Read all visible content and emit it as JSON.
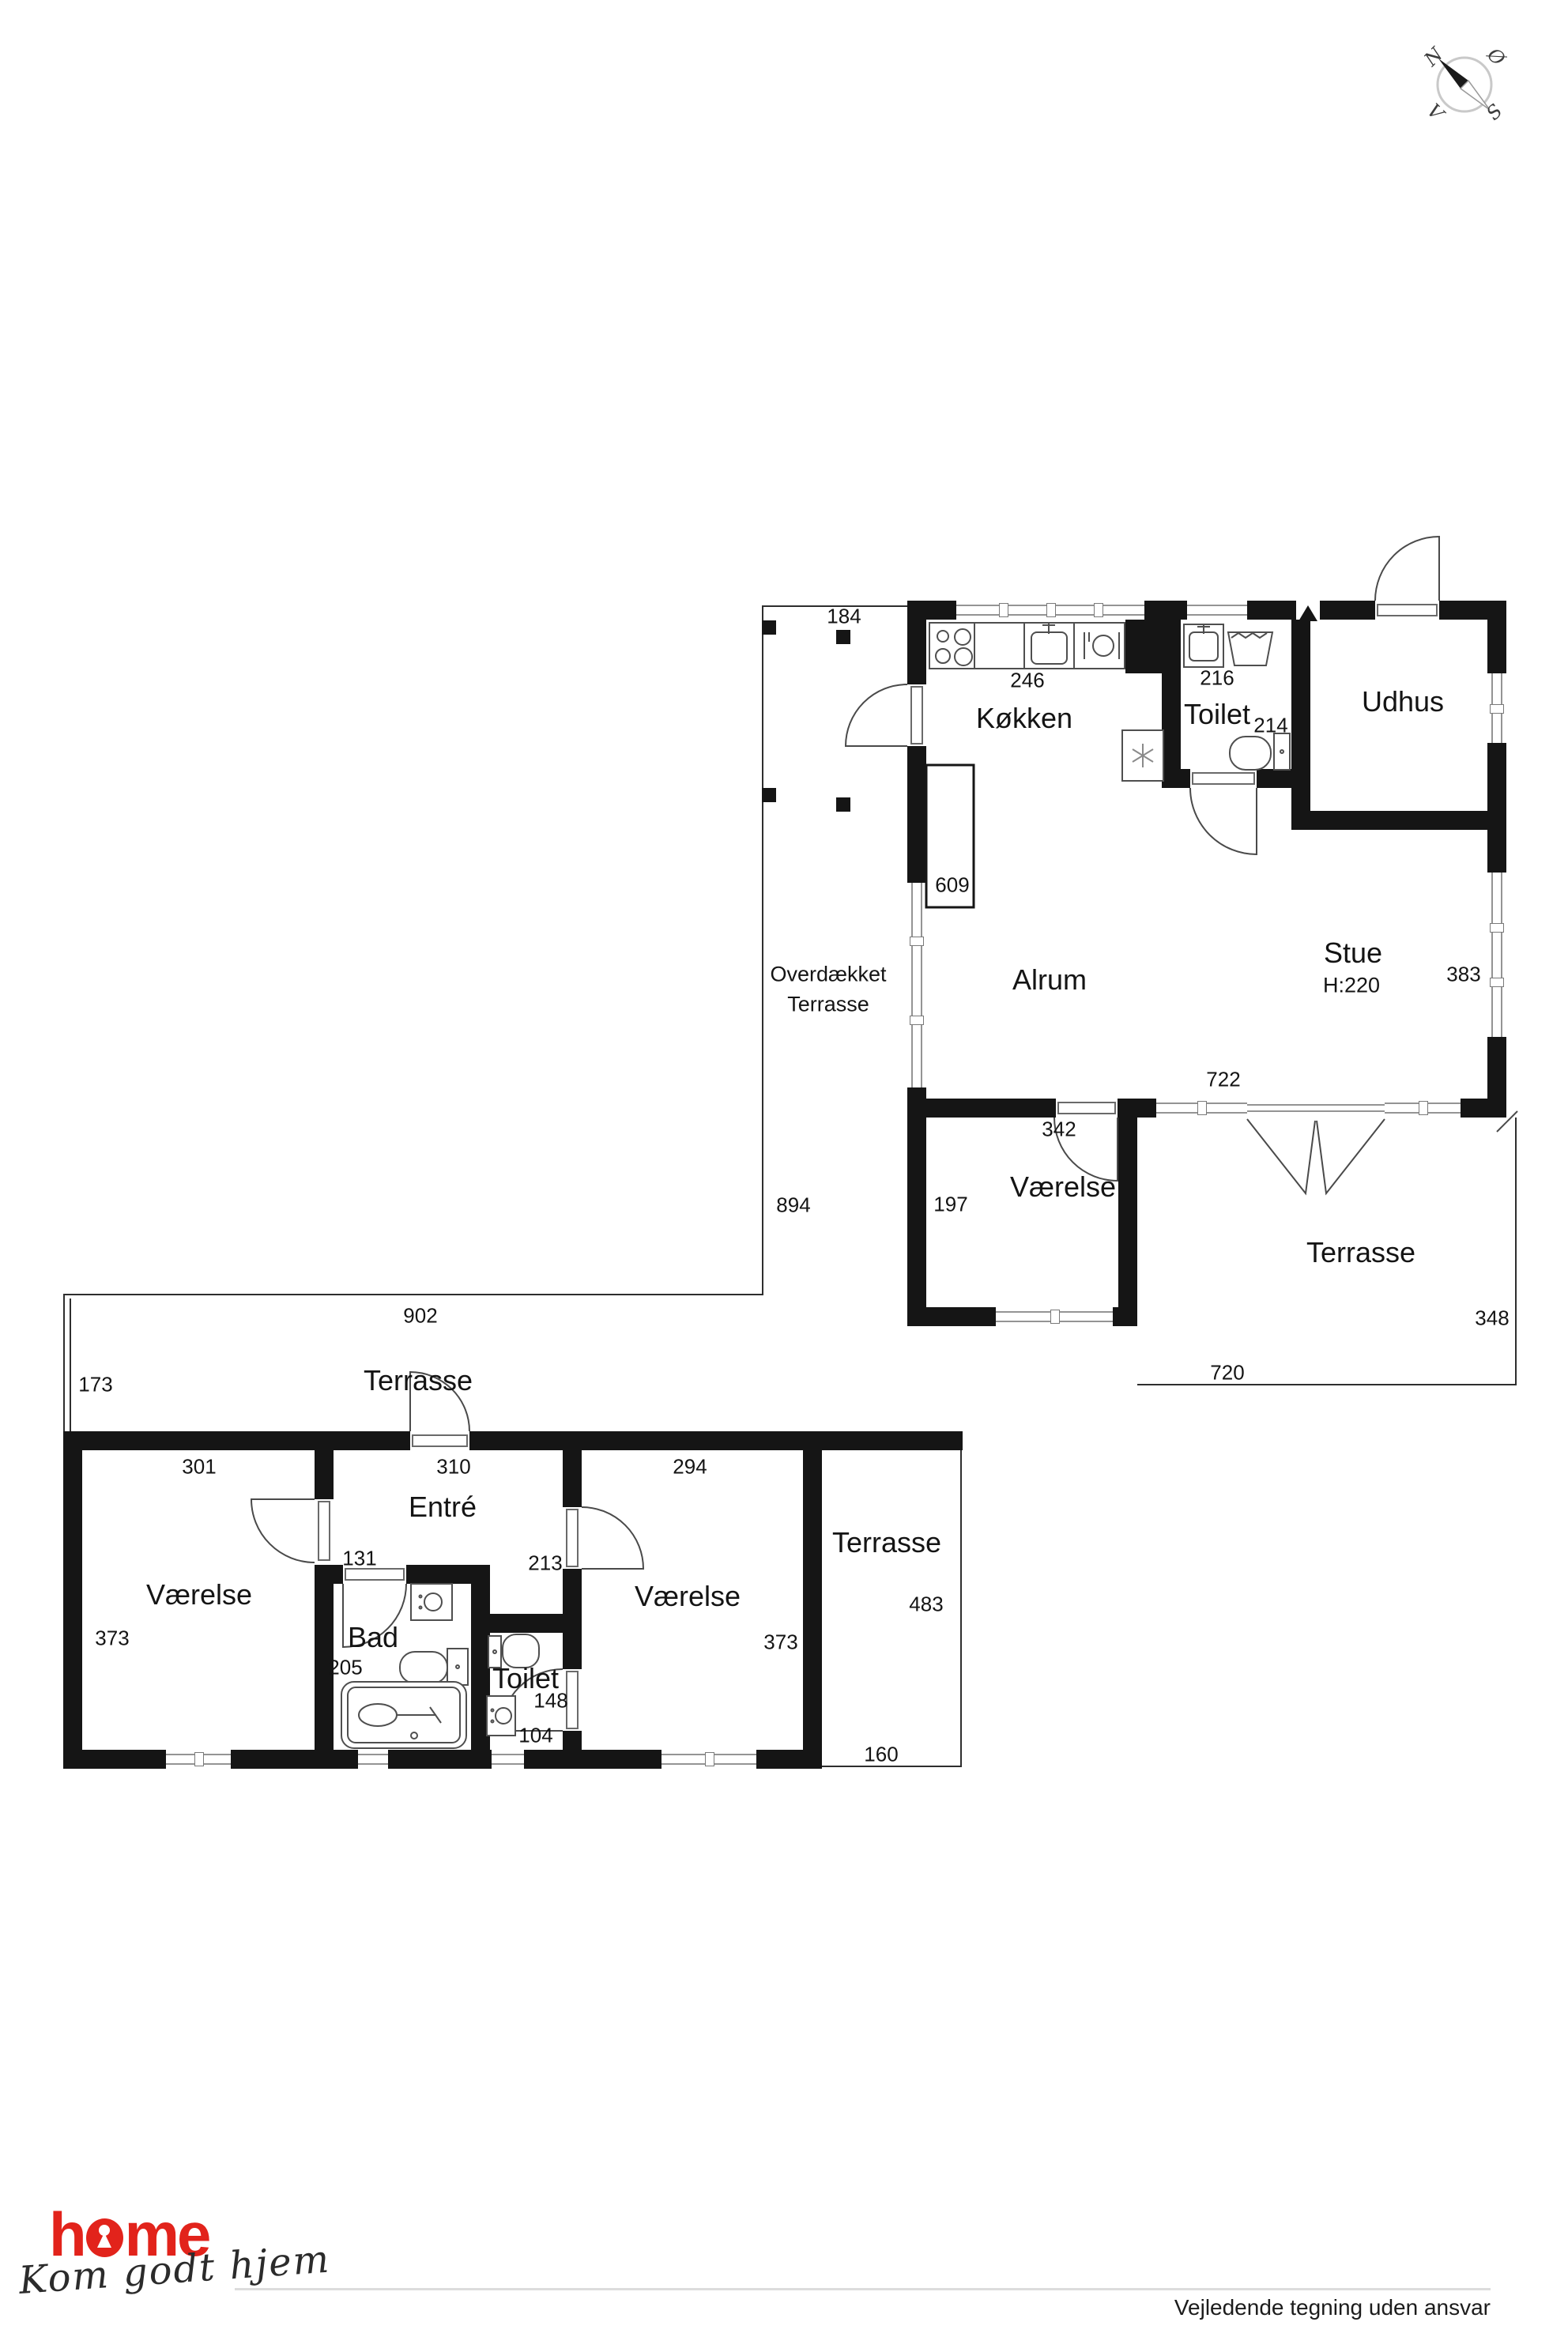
{
  "compass": {
    "n": "N",
    "e": "Ø",
    "s": "S",
    "w": "V"
  },
  "up": {
    "rooms": {
      "kitchen": "Køkken",
      "toilet": "Toilet",
      "shed": "Udhus",
      "alrum": "Alrum",
      "living": "Stue",
      "living_h": "H:220",
      "bedroom": "Værelse",
      "terrace": "Terrasse",
      "covered1": "Overdækket",
      "covered2": "Terrasse"
    },
    "dims": {
      "d184": "184",
      "d246": "246",
      "d216": "216",
      "d214": "214",
      "d609": "609",
      "d383": "383",
      "d722": "722",
      "d342": "342",
      "d197": "197",
      "d894": "894",
      "d348": "348",
      "d720": "720"
    }
  },
  "low": {
    "rooms": {
      "terrace_top": "Terrasse",
      "bed_left": "Værelse",
      "entry": "Entré",
      "bath": "Bad",
      "toilet": "Toilet",
      "bed_right": "Værelse",
      "terrace_right": "Terrasse"
    },
    "dims": {
      "d902": "902",
      "d173": "173",
      "d301": "301",
      "d310": "310",
      "d294": "294",
      "d373a": "373",
      "d131": "131",
      "d205": "205",
      "d213": "213",
      "d148": "148",
      "d104": "104",
      "d373b": "373",
      "d483": "483",
      "d160": "160"
    }
  },
  "logo": {
    "pre": "h",
    "post": "me",
    "tagline": "Kom godt hjem"
  },
  "footer": {
    "disclaimer": "Vejledende tegning uden ansvar"
  }
}
